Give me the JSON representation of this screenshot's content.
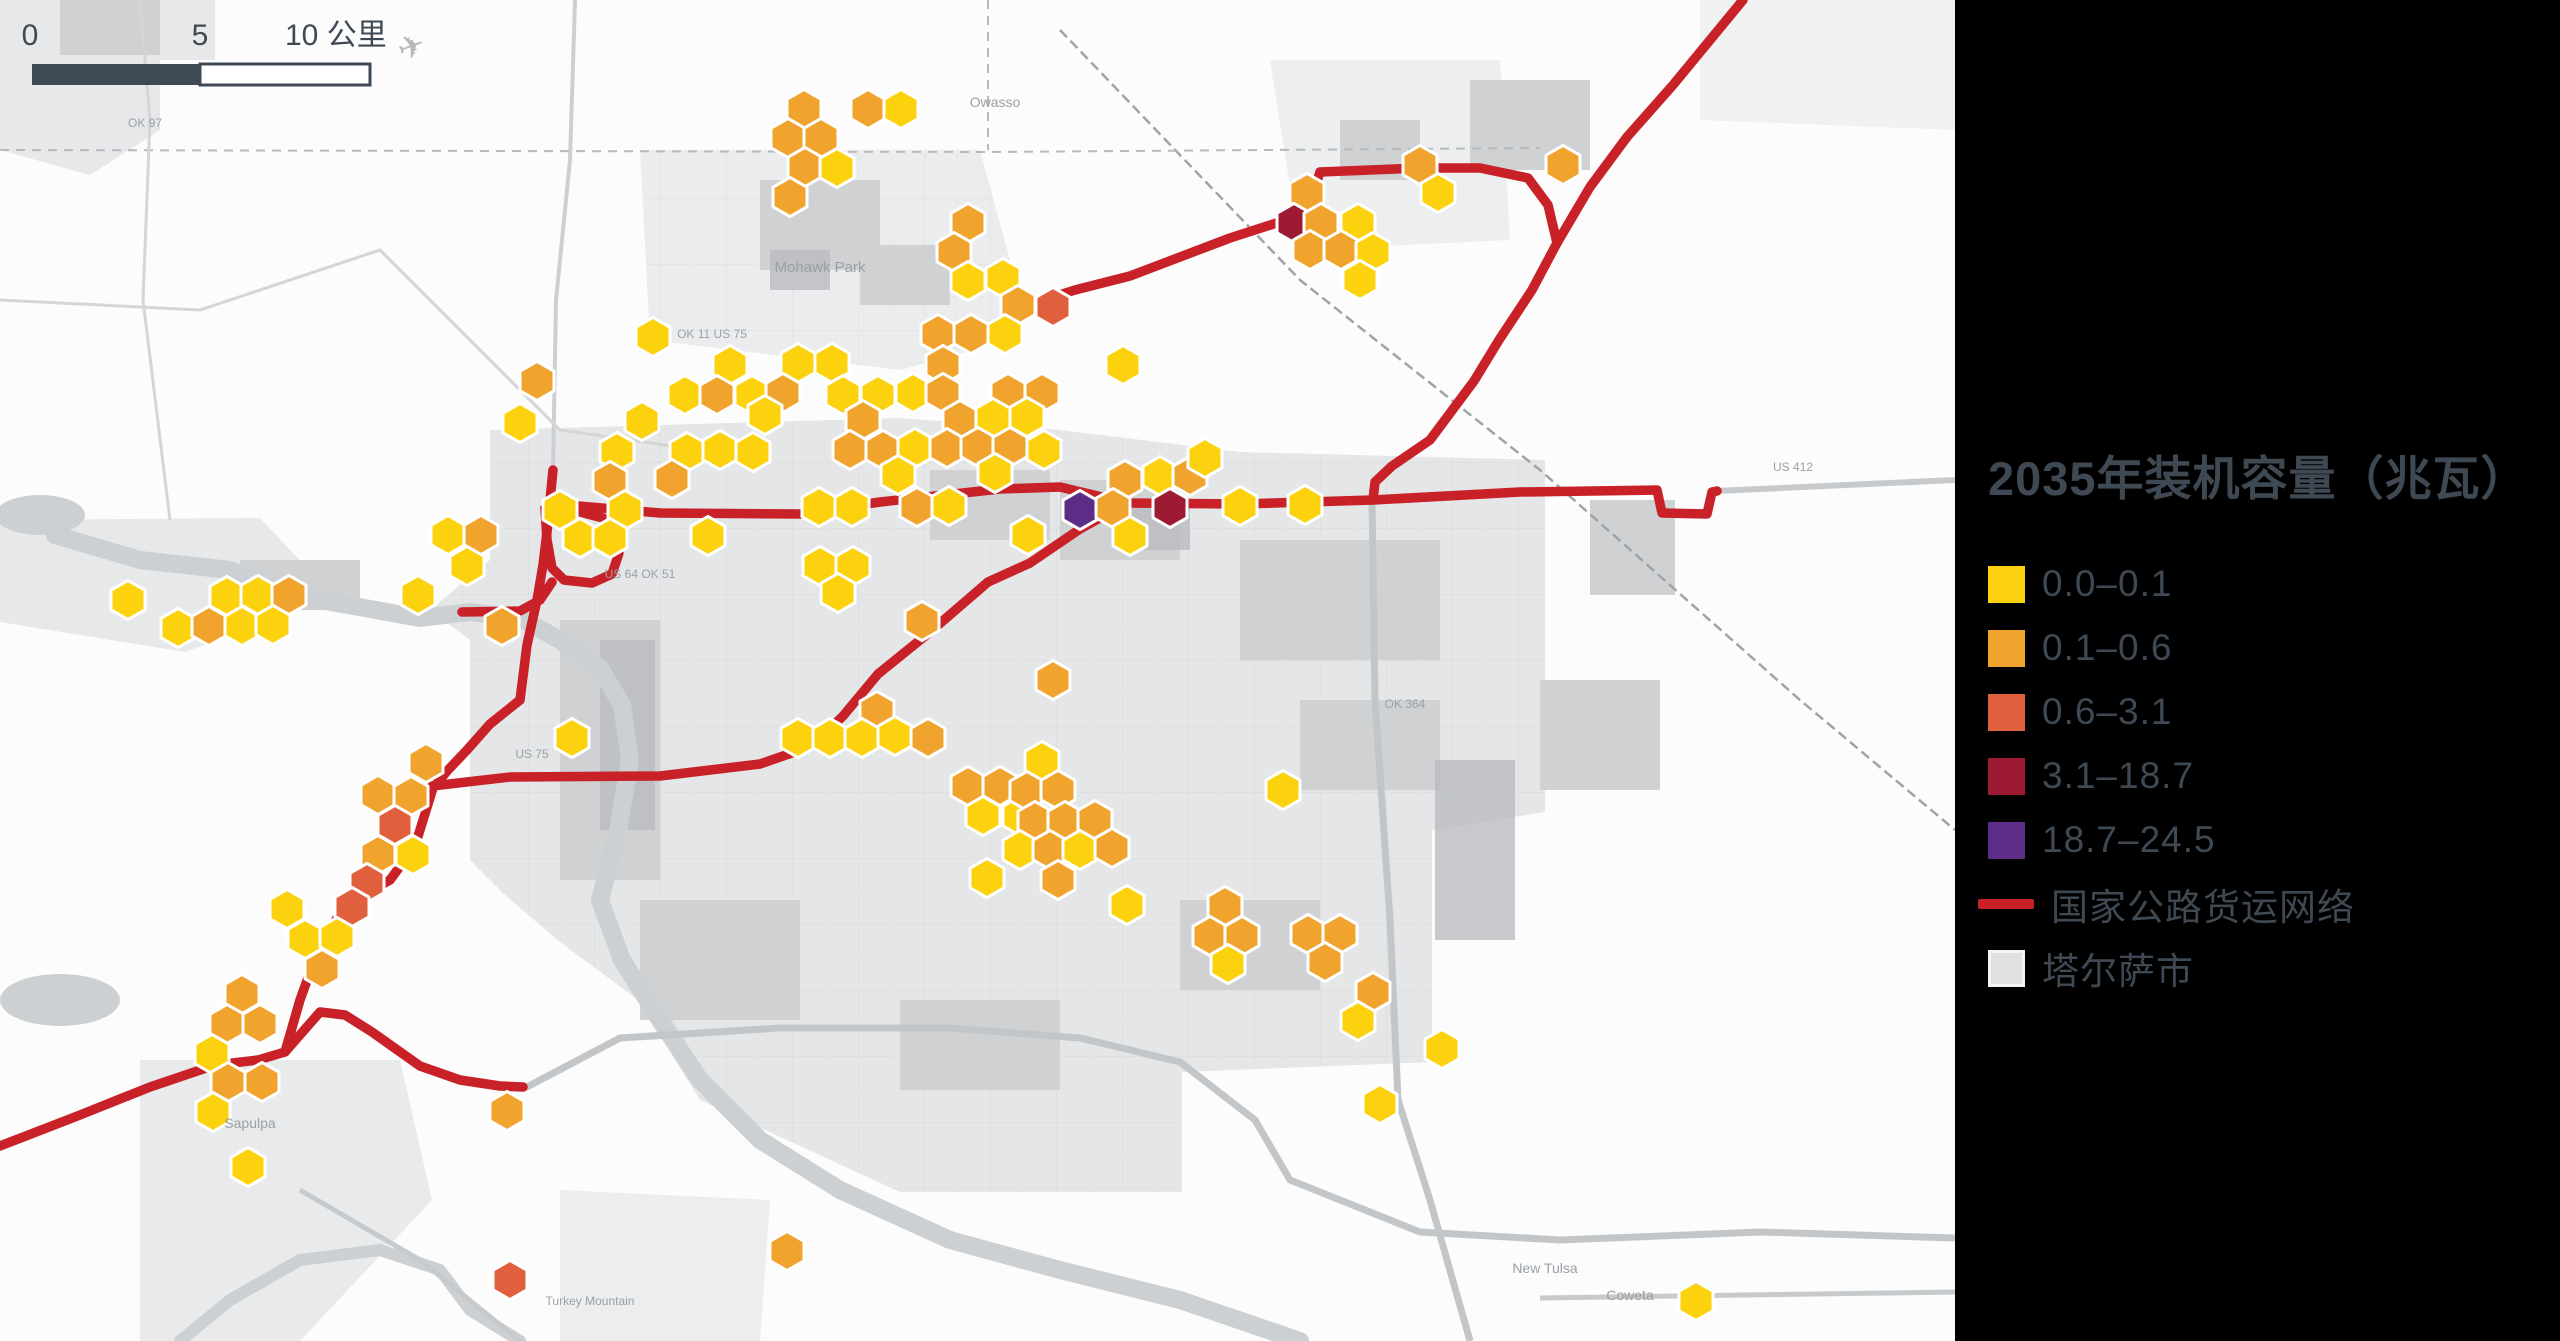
{
  "colors": {
    "bin1": "#fcd20f",
    "bin2": "#f0a42e",
    "bin3": "#e0603e",
    "bin4": "#9c1b33",
    "bin5": "#5c2d87",
    "road": "#c82128",
    "city_fill": "#e0e1e2",
    "text": "#3e4953",
    "map_urban": "#e4e6e7",
    "map_urban_dark": "#cfd1d3",
    "map_water": "#ccd0d2"
  },
  "legend": {
    "title": "2035年装机容量（兆瓦）",
    "items": [
      {
        "label": "0.0–0.1",
        "color": "#fcd20f"
      },
      {
        "label": "0.1–0.6",
        "color": "#f0a42e"
      },
      {
        "label": "0.6–3.1",
        "color": "#e0603e"
      },
      {
        "label": "3.1–18.7",
        "color": "#9c1b33"
      },
      {
        "label": "18.7–24.5",
        "color": "#5c2d87"
      }
    ],
    "road_item": {
      "label": "国家公路货运网络",
      "color": "#c82128"
    },
    "city_item": {
      "label": "塔尔萨市",
      "color": "#e0e1e2"
    }
  },
  "scalebar": {
    "label_0": "0",
    "label_5": "5",
    "label_10": "10 公里",
    "x": 32,
    "y": 64,
    "width": 338,
    "height": 21,
    "dark_until": 200
  },
  "chart_data": {
    "type": "heatmap",
    "title": "2035年装机容量（兆瓦）",
    "bins": [
      "0.0–0.1",
      "0.1–0.6",
      "0.6–3.1",
      "3.1–18.7",
      "18.7–24.5"
    ],
    "bin_colors": [
      "#fcd20f",
      "#f0a42e",
      "#e0603e",
      "#9c1b33",
      "#5c2d87"
    ],
    "bin_counts": [
      83,
      74,
      5,
      2,
      1
    ],
    "legend_position": "right",
    "note": "hex centers in map.hexes as [x,y,bin]"
  },
  "map": {
    "hex_width": 34,
    "hexes": [
      [
        804,
        109,
        2
      ],
      [
        868,
        109,
        2
      ],
      [
        901,
        109,
        1
      ],
      [
        788,
        138,
        2
      ],
      [
        821,
        138,
        2
      ],
      [
        805,
        167,
        2
      ],
      [
        837,
        168,
        1
      ],
      [
        790,
        197,
        2
      ],
      [
        968,
        223,
        2
      ],
      [
        954,
        252,
        2
      ],
      [
        968,
        281,
        1
      ],
      [
        1003,
        278,
        1
      ],
      [
        1018,
        305,
        2
      ],
      [
        1053,
        307,
        3
      ],
      [
        938,
        334,
        2
      ],
      [
        971,
        334,
        2
      ],
      [
        1005,
        334,
        1
      ],
      [
        1420,
        165,
        2
      ],
      [
        1438,
        193,
        1
      ],
      [
        1307,
        193,
        2
      ],
      [
        1294,
        223,
        4
      ],
      [
        1321,
        223,
        2
      ],
      [
        1358,
        223,
        1
      ],
      [
        1310,
        250,
        2
      ],
      [
        1341,
        250,
        2
      ],
      [
        1373,
        252,
        1
      ],
      [
        1360,
        280,
        1
      ],
      [
        1563,
        165,
        2
      ],
      [
        537,
        381,
        2
      ],
      [
        520,
        423,
        1
      ],
      [
        642,
        421,
        1
      ],
      [
        653,
        337,
        1
      ],
      [
        730,
        365,
        1
      ],
      [
        798,
        363,
        1
      ],
      [
        832,
        363,
        1
      ],
      [
        943,
        365,
        2
      ],
      [
        1123,
        365,
        1
      ],
      [
        685,
        395,
        1
      ],
      [
        717,
        395,
        2
      ],
      [
        752,
        395,
        1
      ],
      [
        783,
        393,
        2
      ],
      [
        843,
        395,
        1
      ],
      [
        878,
        395,
        1
      ],
      [
        913,
        393,
        1
      ],
      [
        943,
        393,
        2
      ],
      [
        1008,
        393,
        2
      ],
      [
        1042,
        393,
        2
      ],
      [
        765,
        415,
        1
      ],
      [
        863,
        420,
        2
      ],
      [
        960,
        420,
        2
      ],
      [
        993,
        418,
        1
      ],
      [
        1027,
        417,
        1
      ],
      [
        617,
        452,
        1
      ],
      [
        687,
        452,
        1
      ],
      [
        720,
        450,
        1
      ],
      [
        753,
        452,
        1
      ],
      [
        850,
        450,
        2
      ],
      [
        883,
        450,
        2
      ],
      [
        915,
        448,
        1
      ],
      [
        947,
        448,
        2
      ],
      [
        978,
        447,
        2
      ],
      [
        1010,
        447,
        2
      ],
      [
        1044,
        450,
        1
      ],
      [
        1125,
        480,
        2
      ],
      [
        1160,
        476,
        1
      ],
      [
        1190,
        476,
        2
      ],
      [
        1205,
        458,
        1
      ],
      [
        672,
        479,
        2
      ],
      [
        898,
        475,
        1
      ],
      [
        995,
        473,
        1
      ],
      [
        610,
        481,
        2
      ],
      [
        560,
        510,
        1
      ],
      [
        625,
        510,
        1
      ],
      [
        819,
        507,
        1
      ],
      [
        852,
        507,
        1
      ],
      [
        917,
        507,
        2
      ],
      [
        949,
        506,
        1
      ],
      [
        1080,
        510,
        5
      ],
      [
        1113,
        508,
        2
      ],
      [
        1170,
        508,
        4
      ],
      [
        1240,
        506,
        1
      ],
      [
        1305,
        505,
        1
      ],
      [
        580,
        538,
        1
      ],
      [
        610,
        538,
        1
      ],
      [
        708,
        536,
        1
      ],
      [
        1028,
        535,
        1
      ],
      [
        1130,
        536,
        1
      ],
      [
        448,
        535,
        1
      ],
      [
        481,
        535,
        2
      ],
      [
        467,
        566,
        1
      ],
      [
        418,
        595,
        1
      ],
      [
        502,
        626,
        2
      ],
      [
        128,
        600,
        1
      ],
      [
        227,
        596,
        1
      ],
      [
        258,
        595,
        1
      ],
      [
        289,
        595,
        2
      ],
      [
        178,
        628,
        1
      ],
      [
        209,
        626,
        2
      ],
      [
        242,
        626,
        1
      ],
      [
        273,
        625,
        1
      ],
      [
        820,
        566,
        1
      ],
      [
        853,
        566,
        1
      ],
      [
        838,
        593,
        1
      ],
      [
        922,
        621,
        2
      ],
      [
        572,
        738,
        1
      ],
      [
        877,
        711,
        2
      ],
      [
        798,
        738,
        1
      ],
      [
        830,
        738,
        1
      ],
      [
        862,
        738,
        1
      ],
      [
        895,
        736,
        1
      ],
      [
        928,
        738,
        2
      ],
      [
        968,
        786,
        2
      ],
      [
        1000,
        786,
        2
      ],
      [
        983,
        816,
        1
      ],
      [
        1020,
        816,
        1
      ],
      [
        987,
        878,
        1
      ],
      [
        1042,
        761,
        1
      ],
      [
        1027,
        791,
        2
      ],
      [
        1058,
        790,
        2
      ],
      [
        1035,
        821,
        2
      ],
      [
        1065,
        821,
        2
      ],
      [
        1095,
        820,
        2
      ],
      [
        1020,
        850,
        1
      ],
      [
        1050,
        850,
        2
      ],
      [
        1080,
        850,
        1
      ],
      [
        1112,
        848,
        2
      ],
      [
        1058,
        880,
        2
      ],
      [
        1127,
        905,
        1
      ],
      [
        1283,
        790,
        1
      ],
      [
        1053,
        680,
        2
      ],
      [
        1225,
        906,
        2
      ],
      [
        1210,
        936,
        2
      ],
      [
        1242,
        936,
        2
      ],
      [
        1228,
        964,
        1
      ],
      [
        1308,
        934,
        2
      ],
      [
        1340,
        934,
        2
      ],
      [
        1325,
        962,
        2
      ],
      [
        1373,
        992,
        2
      ],
      [
        1358,
        1021,
        1
      ],
      [
        1442,
        1049,
        1
      ],
      [
        1380,
        1104,
        1
      ],
      [
        426,
        763,
        2
      ],
      [
        378,
        795,
        2
      ],
      [
        411,
        796,
        2
      ],
      [
        395,
        825,
        3
      ],
      [
        378,
        855,
        2
      ],
      [
        413,
        855,
        1
      ],
      [
        367,
        883,
        3
      ],
      [
        287,
        909,
        1
      ],
      [
        352,
        907,
        3
      ],
      [
        305,
        939,
        1
      ],
      [
        337,
        937,
        1
      ],
      [
        322,
        969,
        2
      ],
      [
        242,
        994,
        2
      ],
      [
        227,
        1024,
        2
      ],
      [
        260,
        1024,
        2
      ],
      [
        212,
        1054,
        1
      ],
      [
        228,
        1082,
        2
      ],
      [
        262,
        1082,
        2
      ],
      [
        213,
        1112,
        1
      ],
      [
        248,
        1167,
        1
      ],
      [
        507,
        1111,
        2
      ],
      [
        510,
        1280,
        3
      ],
      [
        787,
        1251,
        2
      ],
      [
        1696,
        1301,
        1
      ]
    ],
    "roads_red": [
      [
        [
          545,
          508
        ],
        [
          578,
          506
        ],
        [
          660,
          513
        ],
        [
          800,
          514
        ],
        [
          880,
          502
        ],
        [
          1000,
          489
        ],
        [
          1060,
          487
        ],
        [
          1127,
          503
        ],
        [
          1240,
          504
        ],
        [
          1373,
          500
        ],
        [
          1520,
          492
        ],
        [
          1657,
          490
        ],
        [
          1662,
          513
        ],
        [
          1707,
          514
        ],
        [
          1712,
          492
        ],
        [
          1717,
          491
        ]
      ],
      [
        [
          1743,
          0
        ],
        [
          1673,
          85
        ],
        [
          1627,
          137
        ],
        [
          1590,
          187
        ],
        [
          1557,
          243
        ],
        [
          1532,
          290
        ],
        [
          1499,
          340
        ],
        [
          1474,
          381
        ],
        [
          1430,
          440
        ],
        [
          1392,
          466
        ],
        [
          1375,
          482
        ],
        [
          1373,
          500
        ]
      ],
      [
        [
          1018,
          308
        ],
        [
          1075,
          290
        ],
        [
          1130,
          276
        ],
        [
          1230,
          238
        ],
        [
          1292,
          218
        ],
        [
          1312,
          196
        ],
        [
          1320,
          172
        ],
        [
          1420,
          168
        ],
        [
          1480,
          168
        ],
        [
          1528,
          178
        ],
        [
          1548,
          205
        ],
        [
          1557,
          243
        ]
      ],
      [
        [
          1127,
          503
        ],
        [
          1080,
          529
        ],
        [
          1030,
          563
        ],
        [
          988,
          582
        ],
        [
          930,
          632
        ],
        [
          878,
          674
        ],
        [
          843,
          716
        ],
        [
          812,
          746
        ],
        [
          760,
          764
        ],
        [
          660,
          776
        ],
        [
          510,
          777
        ],
        [
          432,
          786
        ]
      ],
      [
        [
          553,
          470
        ],
        [
          550,
          500
        ],
        [
          547,
          532
        ],
        [
          543,
          565
        ],
        [
          537,
          600
        ],
        [
          527,
          645
        ],
        [
          520,
          700
        ],
        [
          490,
          724
        ],
        [
          467,
          750
        ],
        [
          448,
          770
        ],
        [
          433,
          788
        ],
        [
          415,
          846
        ],
        [
          390,
          880
        ],
        [
          345,
          905
        ],
        [
          318,
          950
        ],
        [
          300,
          1000
        ],
        [
          285,
          1052
        ]
      ],
      [
        [
          0,
          1146
        ],
        [
          80,
          1115
        ],
        [
          150,
          1087
        ],
        [
          215,
          1065
        ],
        [
          258,
          1060
        ],
        [
          285,
          1052
        ],
        [
          320,
          1012
        ],
        [
          345,
          1015
        ],
        [
          372,
          1032
        ],
        [
          420,
          1066
        ],
        [
          460,
          1080
        ],
        [
          500,
          1086
        ],
        [
          523,
          1087
        ]
      ],
      [
        [
          545,
          508
        ],
        [
          547,
          540
        ],
        [
          552,
          568
        ],
        [
          564,
          580
        ],
        [
          592,
          583
        ],
        [
          612,
          574
        ],
        [
          619,
          553
        ],
        [
          616,
          530
        ],
        [
          603,
          518
        ],
        [
          580,
          512
        ],
        [
          553,
          505
        ]
      ],
      [
        [
          462,
          612
        ],
        [
          520,
          611
        ],
        [
          540,
          600
        ],
        [
          552,
          582
        ]
      ]
    ],
    "labels": [
      {
        "t": "Mohawk Park",
        "x": 820,
        "y": 272,
        "s": 15
      },
      {
        "t": "Owasso",
        "x": 995,
        "y": 107,
        "s": 14
      },
      {
        "t": "New Tulsa",
        "x": 1545,
        "y": 1273,
        "s": 14
      },
      {
        "t": "Coweta",
        "x": 1630,
        "y": 1300,
        "s": 14
      },
      {
        "t": "Sapulpa",
        "x": 250,
        "y": 1128,
        "s": 14
      },
      {
        "t": "Turkey Mountain",
        "x": 590,
        "y": 1305,
        "s": 12
      },
      {
        "t": "OK 11  US 75",
        "x": 712,
        "y": 338,
        "s": 12
      },
      {
        "t": "US 64  OK 51",
        "x": 640,
        "y": 578,
        "s": 12
      },
      {
        "t": "US 75",
        "x": 532,
        "y": 758,
        "s": 12
      },
      {
        "t": "US 412",
        "x": 1793,
        "y": 471,
        "s": 12
      },
      {
        "t": "OK 364",
        "x": 1405,
        "y": 708,
        "s": 12
      },
      {
        "t": "OK 97",
        "x": 145,
        "y": 127,
        "s": 12
      }
    ]
  }
}
